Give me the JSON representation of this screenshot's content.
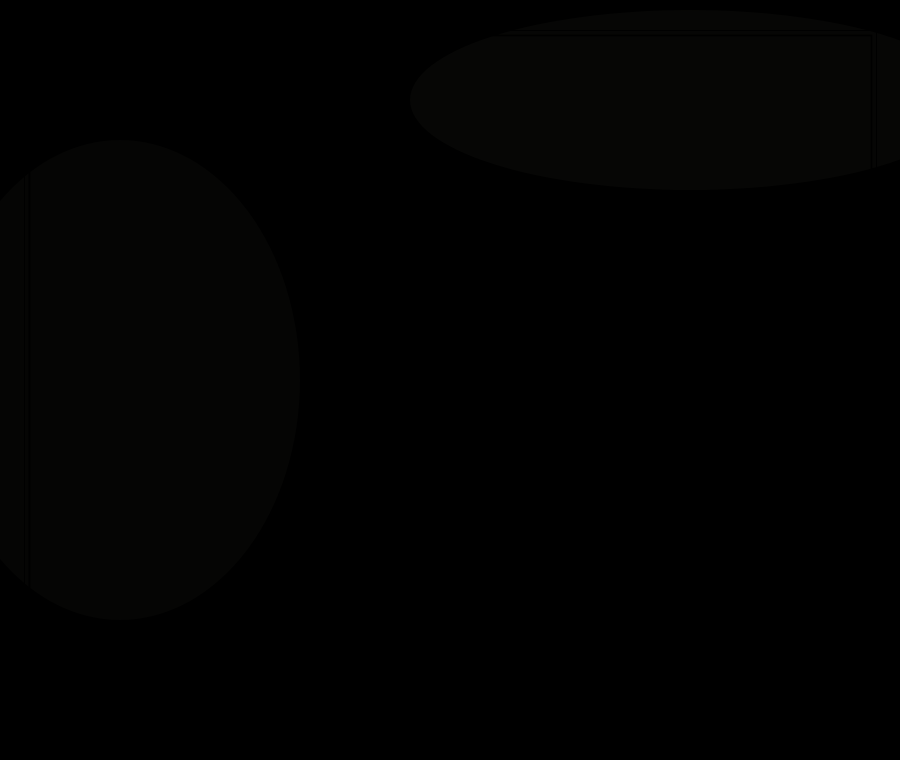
{
  "artwork": {
    "signature": "Joseph Q. Adams.",
    "colors": {
      "paper": "#eae6d8",
      "ink": "#2b2c31",
      "faint_mark": "#a9b5c3"
    }
  }
}
